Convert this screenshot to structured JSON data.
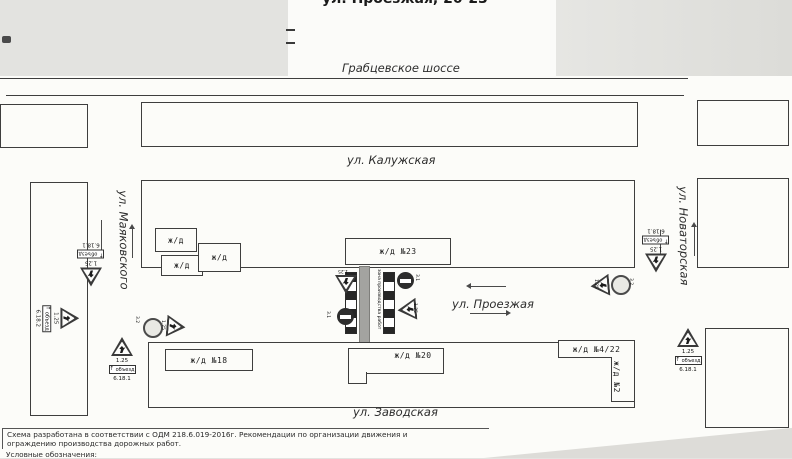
{
  "title": "ул. Проезжая, 20-23",
  "streets": {
    "grabtsevskoe": "Грабцевское шоссе",
    "kaluzhskaya": "ул. Калужская",
    "mayakovskogo": "ул. Маяковского",
    "novatorskaya": "ул. Новаторская",
    "proezzhaya": "ул. Проезжая",
    "zavodskaya": "ул. Заводская"
  },
  "buildings": {
    "small_house": "ж/д",
    "house23": "ж/д  №23",
    "house18": "ж/д  №18",
    "house20": "ж/д  №20",
    "house422": "ж/д  №4/22",
    "house2": "ж/д  №2"
  },
  "signs": {
    "roadworks": "1.25",
    "no_entry": "3.1",
    "no_traffic": "3.2",
    "detour_straight": "6.18.1",
    "detour_right": "6.18.2",
    "detour_plate": "объезд",
    "plate_arrow": "↑"
  },
  "work_zone": {
    "label": "зона производства работ"
  },
  "footer": {
    "line1": "Схема разработана в соответствии с ОДМ 218.6.019-2016г. Рекомендации по организации движения и",
    "line2": "ограждению производства дорожных работ.",
    "line3": "Условные обозначения:"
  },
  "colors": {
    "line": "#3e3e3e",
    "paper": "#fcfcf9",
    "scan_bg": "#e3e3e0",
    "work_zone_fill": "#a3a3a0"
  }
}
